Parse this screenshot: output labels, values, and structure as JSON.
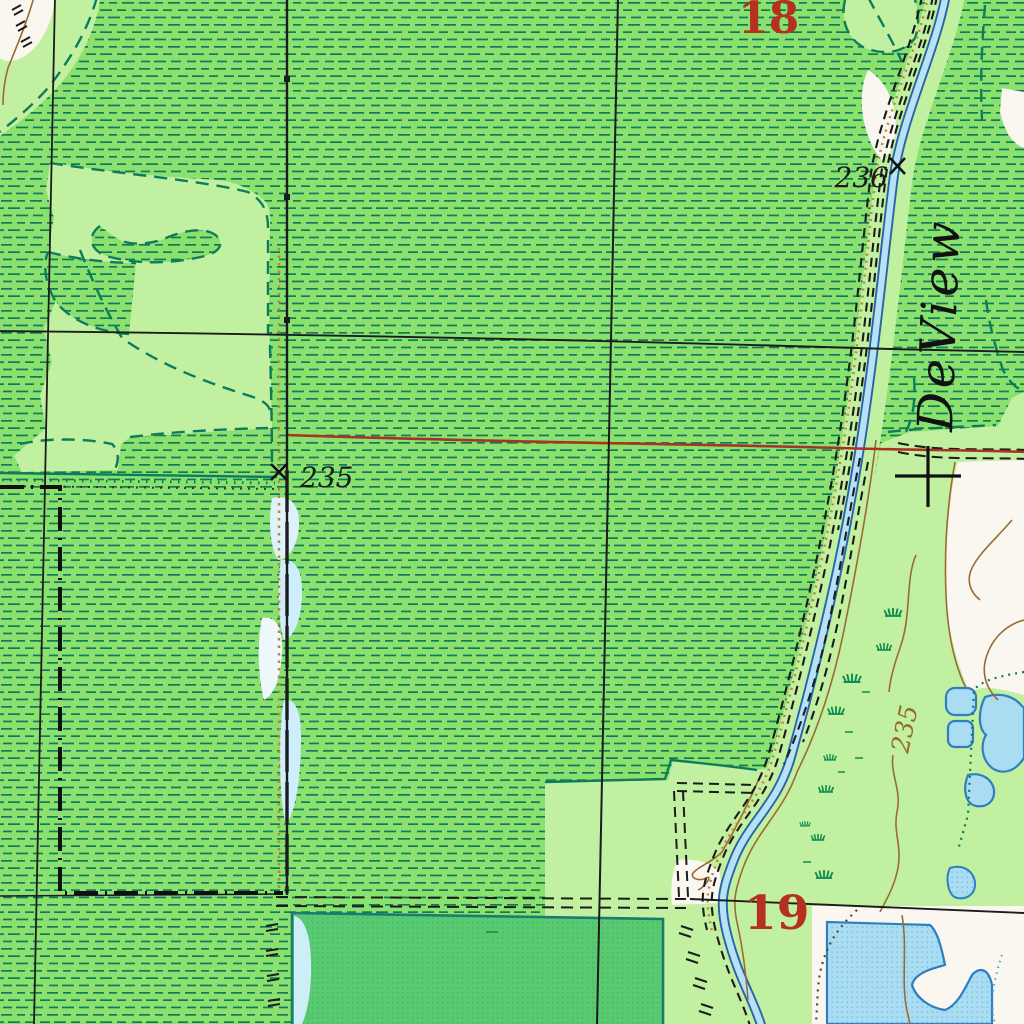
{
  "map": {
    "title": "USGS topographic quadrangle excerpt - DeView bayou area",
    "section_numbers": {
      "upper": "18",
      "lower": "19"
    },
    "spot_elevations": {
      "near_stream": "236",
      "near_trail": "235"
    },
    "contour_labels": {
      "east_of_stream": "235"
    },
    "stream_name": "DeView",
    "icons": {
      "spot_elevation_x_upper": "x-mark-icon",
      "spot_elevation_x_left": "x-mark-icon",
      "grid_tick_cross": "cross-icon"
    },
    "colors": {
      "marsh_green": "#8ce06e",
      "marsh_dash_teal": "#0d7c5a",
      "clearing_light_green": "#c1f0a0",
      "open_white": "#f9f7ef",
      "stream_light_blue": "#b7e2f6",
      "stream_dark_blue": "#2a63a8",
      "water_blue": "#aadcf2",
      "water_border_blue": "#2f7fc0",
      "pond_green": "#58ca72",
      "pond_border_teal": "#1d7a70",
      "section_number_red": "#b5301f",
      "red_line": "#a83322",
      "contour_brown": "#9c6b33",
      "trail_orange": "#c58233",
      "line_black": "#1c1c1c"
    }
  }
}
